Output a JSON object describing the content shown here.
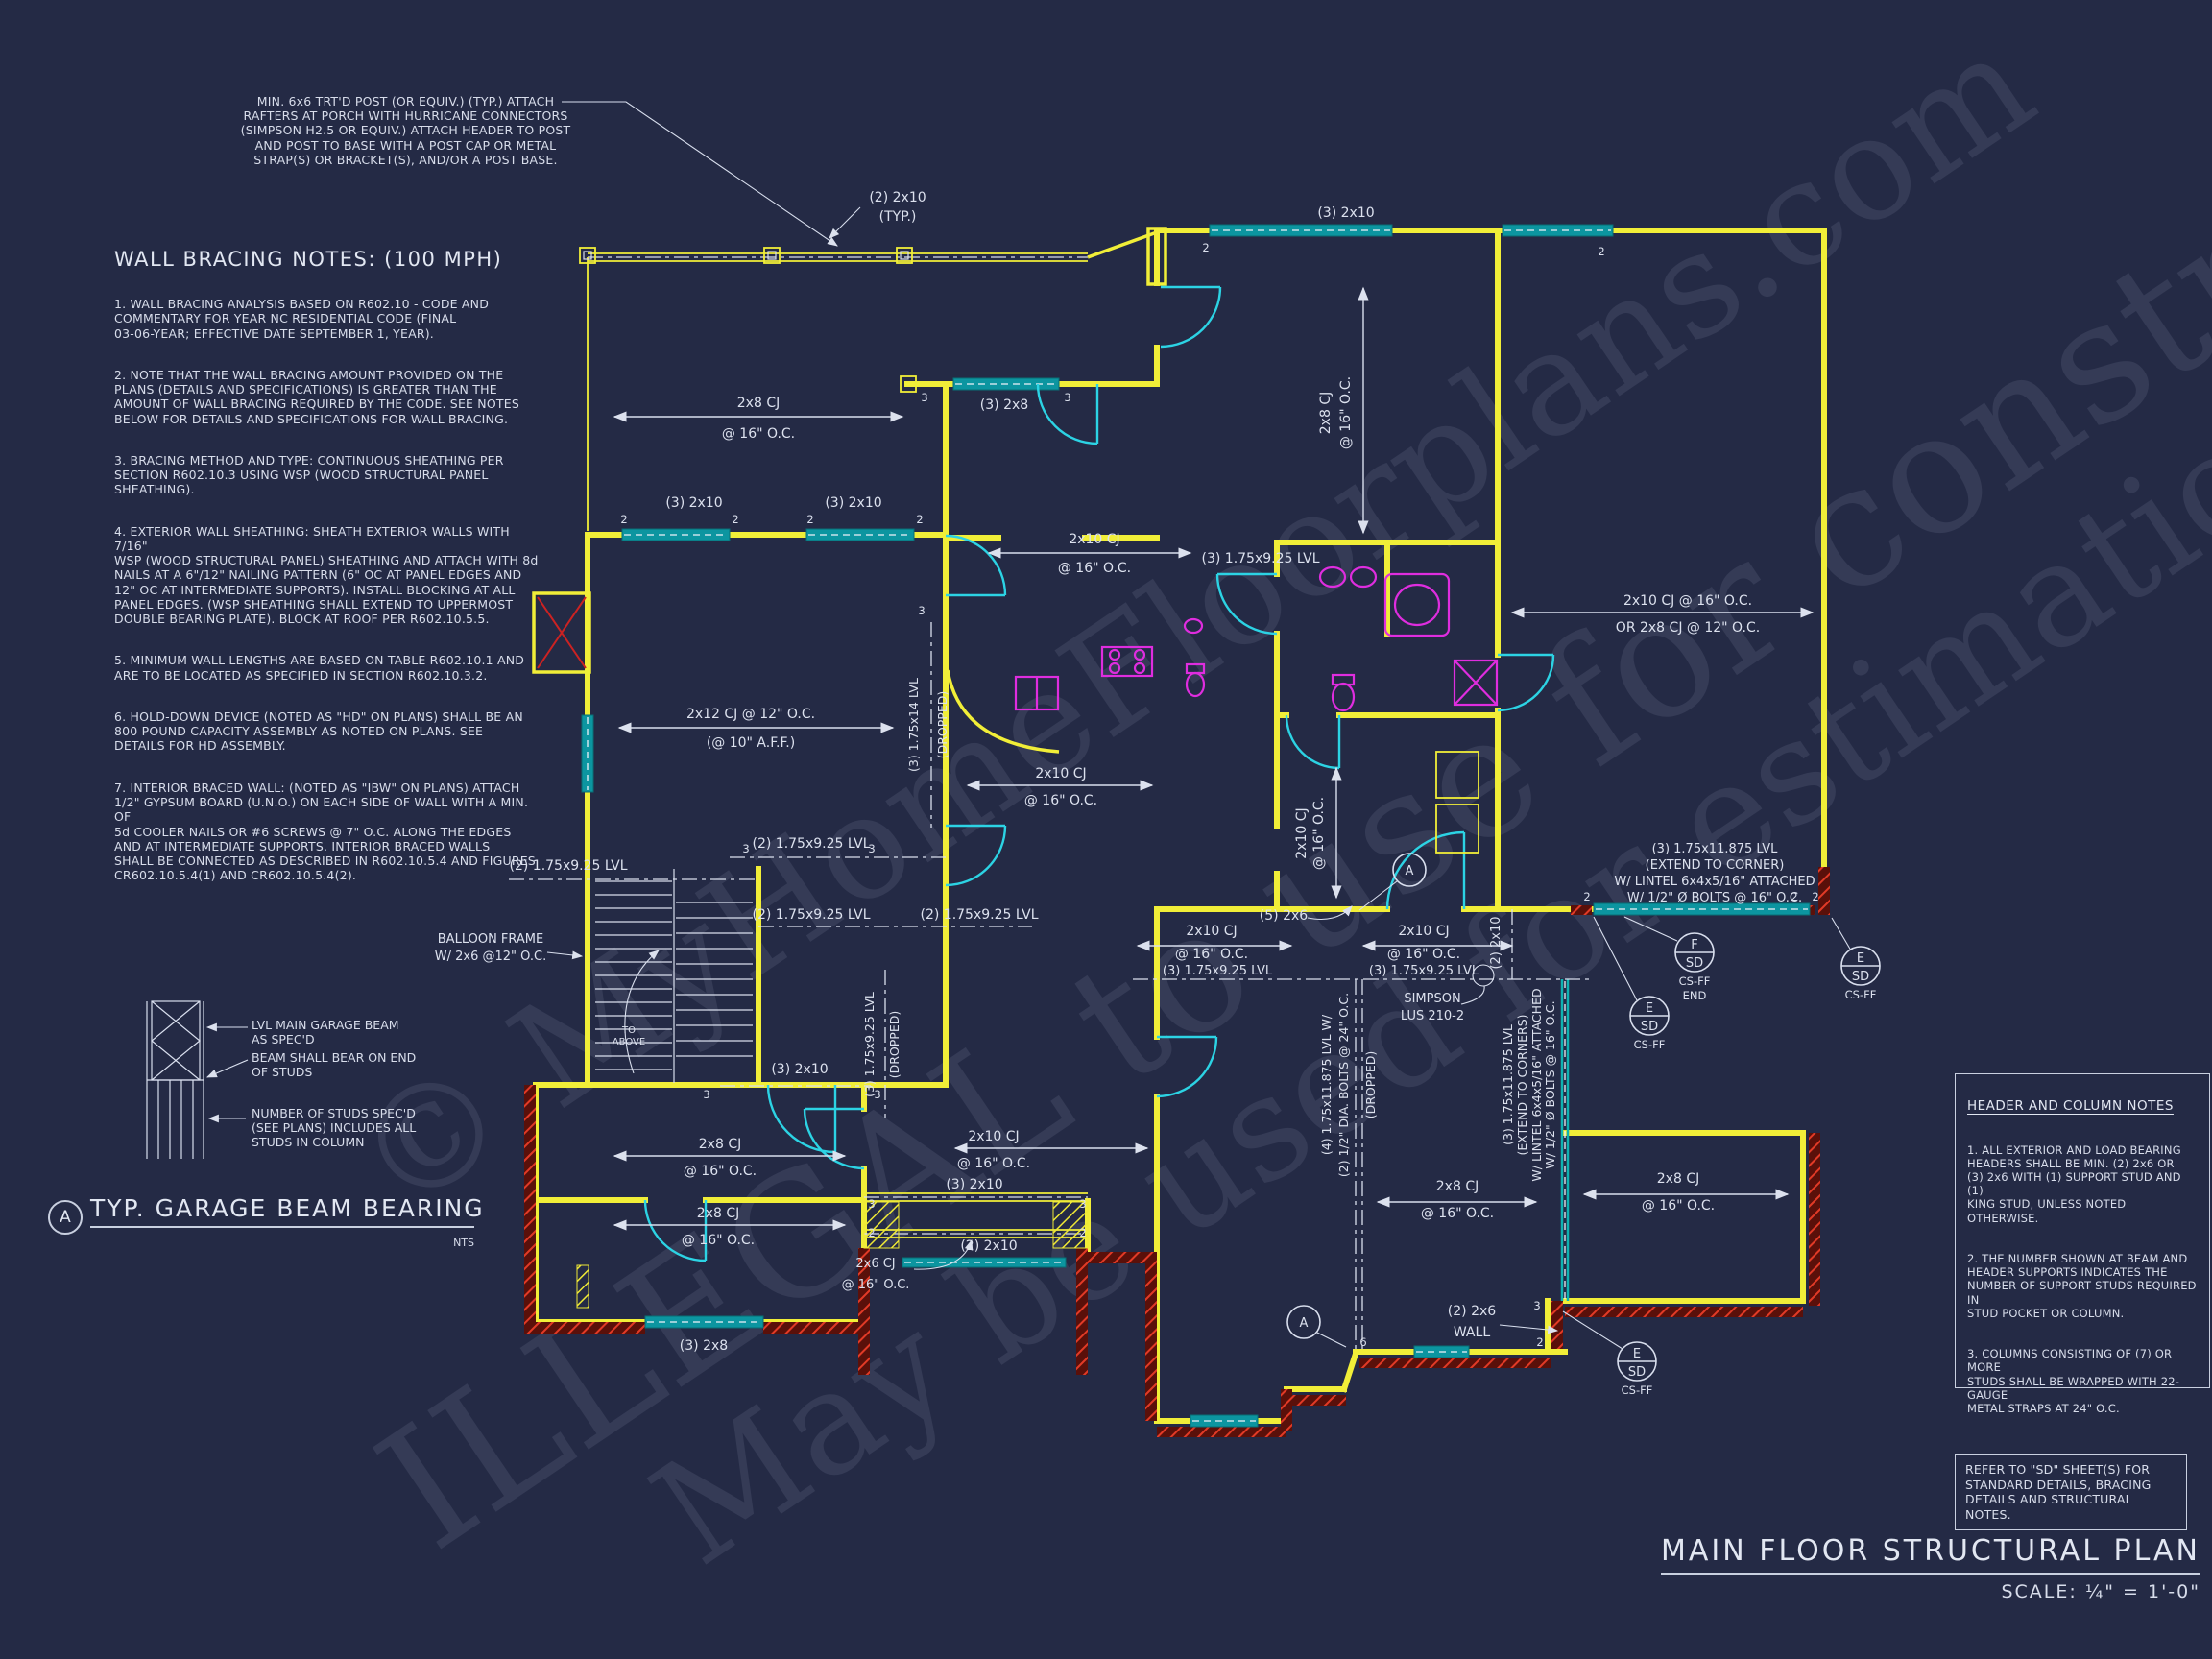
{
  "colors": {
    "background": "#242a45",
    "wall_yellow": "#f1ee38",
    "header_teal": "#0c95a0",
    "door_cyan": "#2cd3e4",
    "fixture_magenta": "#df2ddf",
    "brick_red": "#5a100a",
    "brick_hatch_red": "#e23a26",
    "ink_white": "#dce1ee"
  },
  "watermark": {
    "line1": "© MyHomeFloorplans.com",
    "line2": "ILLEGAL to use for construction",
    "line3": "May be used for estimations"
  },
  "post_note": "MIN. 6x6 TRT'D POST (OR EQUIV.) (TYP.) ATTACH\nRAFTERS AT PORCH WITH HURRICANE CONNECTORS\n(SIMPSON H2.5 OR EQUIV.) ATTACH HEADER TO POST\nAND POST TO BASE WITH A POST CAP OR METAL\nSTRAP(S) OR BRACKET(S), AND/OR A POST BASE.",
  "wall_bracing": {
    "title": "WALL BRACING NOTES: (100 MPH)",
    "n1": "1. WALL BRACING ANALYSIS BASED ON R602.10 - CODE AND\nCOMMENTARY FOR YEAR NC RESIDENTIAL CODE (FINAL\n03-06-YEAR; EFFECTIVE DATE SEPTEMBER 1, YEAR).",
    "n2": "2. NOTE THAT THE WALL BRACING AMOUNT PROVIDED ON THE\nPLANS (DETAILS AND SPECIFICATIONS) IS GREATER THAN THE\nAMOUNT OF WALL BRACING REQUIRED BY THE CODE. SEE NOTES\nBELOW FOR DETAILS AND SPECIFICATIONS FOR WALL BRACING.",
    "n3": "3. BRACING METHOD AND TYPE: CONTINUOUS SHEATHING PER\nSECTION R602.10.3 USING WSP (WOOD STRUCTURAL PANEL\nSHEATHING).",
    "n4": "4. EXTERIOR WALL SHEATHING: SHEATH EXTERIOR WALLS WITH 7/16\"\nWSP (WOOD STRUCTURAL PANEL) SHEATHING AND ATTACH WITH 8d\nNAILS AT A 6\"/12\" NAILING PATTERN (6\" OC AT PANEL EDGES AND\n12\" OC AT INTERMEDIATE SUPPORTS). INSTALL BLOCKING AT ALL\nPANEL EDGES. (WSP SHEATHING SHALL EXTEND TO UPPERMOST\nDOUBLE BEARING PLATE). BLOCK AT ROOF PER R602.10.5.5.",
    "n5": "5. MINIMUM WALL LENGTHS ARE BASED ON TABLE R602.10.1 AND\nARE TO BE LOCATED AS SPECIFIED IN SECTION R602.10.3.2.",
    "n6": "6. HOLD-DOWN DEVICE (NOTED AS \"HD\" ON PLANS) SHALL BE AN\n800 POUND CAPACITY ASSEMBLY AS NOTED ON PLANS. SEE\nDETAILS FOR HD ASSEMBLY.",
    "n7": "7. INTERIOR BRACED WALL: (NOTED AS \"IBW\" ON PLANS) ATTACH\n1/2\" GYPSUM BOARD (U.N.O.) ON EACH SIDE OF WALL WITH A MIN. OF\n5d COOLER NAILS OR #6 SCREWS @ 7\" O.C. ALONG THE EDGES\nAND AT INTERMEDIATE SUPPORTS.  INTERIOR BRACED WALLS\nSHALL BE CONNECTED AS DESCRIBED IN R602.10.5.4 AND FIGURES\nCR602.10.5.4(1) AND CR602.10.5.4(2)."
  },
  "detail": {
    "bubble": "A",
    "label_beam": "LVL MAIN GARAGE BEAM\nAS SPEC'D",
    "label_bear": "BEAM SHALL BEAR ON END\nOF STUDS",
    "label_studs": "NUMBER OF STUDS SPEC'D\n(SEE PLANS) INCLUDES ALL\nSTUDS IN COLUMN",
    "title": "TYP. GARAGE BEAM BEARING",
    "nts": "NTS"
  },
  "header_notes": {
    "title": "HEADER AND COLUMN NOTES",
    "n1": "1. ALL EXTERIOR AND LOAD BEARING\nHEADERS SHALL BE MIN. (2) 2x6 OR\n(3) 2x6 WITH (1) SUPPORT STUD AND (1)\nKING STUD, UNLESS NOTED OTHERWISE.",
    "n2": "2. THE NUMBER SHOWN AT BEAM AND\nHEADER SUPPORTS INDICATES THE\nNUMBER OF SUPPORT STUDS REQUIRED IN\nSTUD POCKET OR COLUMN.",
    "n3": "3. COLUMNS CONSISTING OF (7) OR MORE\nSTUDS SHALL BE WRAPPED WITH 22-GAUGE\nMETAL STRAPS AT 24\" O.C."
  },
  "sd_box": "REFER TO \"SD\"  SHEET(S) FOR\nSTANDARD DETAILS, BRACING\nDETAILS AND STRUCTURAL NOTES.",
  "titleblock": {
    "title": "MAIN FLOOR STRUCTURAL PLAN",
    "scale": "SCALE: ¼\" = 1'-0\""
  },
  "plan": {
    "t_2_2x10": "(2) 2x10",
    "t_typ": "(TYP.)",
    "t_3_2x10": "(3) 2x10",
    "t_3_2x8": "(3) 2x8",
    "t_2x8cj": "2x8 CJ",
    "t_2x10cj": "2x10 CJ",
    "t_2x6cj": "2x6 CJ",
    "t_at16": "@ 16\" O.C.",
    "t_2x12cj": "2x12 CJ @ 12\" O.C.",
    "t_aff": "(@ 10\" A.F.F.)",
    "t_or_line1": "2x10 CJ @ 16\" O.C.",
    "t_or_line2": "OR 2x8 CJ @ 12\" O.C.",
    "t_3lvl925": "(3) 1.75x9.25 LVL",
    "t_2lvl925": "(2) 1.75x9.25 LVL",
    "t_3lvl14": "(3) 1.75x14 LVL",
    "t_dropped": "(DROPPED)",
    "t_3lvl11875": "(3) 1.75x11.875 LVL",
    "t_ext_corner": "(EXTEND TO CORNER)",
    "t_ext_corners": "(EXTEND TO CORNERS)",
    "t_lintel": "W/ LINTEL 6x4x5/16\" ATTACHED",
    "t_bolts16": "W/ 1/2\" Ø BOLTS @ 16\" O.C.",
    "t_4lvl": "(4) 1.75x11.875 LVL W/",
    "t_bolts24": "(2) 1/2\" DIA. BOLTS @ 24\" O.C.",
    "t_simpson1": "SIMPSON",
    "t_simpson2": "LUS 210-2",
    "t_5_2x6": "(5) 2x6",
    "t_2_2x6": "(2) 2x6",
    "t_wall": "WALL",
    "t_balloon1": "BALLOON FRAME",
    "t_balloon2": "W/ 2x6 @12\" O.C.",
    "t_to": "TO",
    "t_above": "ABOVE",
    "n2": "2",
    "n3": "3",
    "n6": "6"
  },
  "callouts": {
    "f": "F",
    "e": "E",
    "sd": "SD",
    "a": "A",
    "csff": "CS-FF",
    "end": "END"
  }
}
